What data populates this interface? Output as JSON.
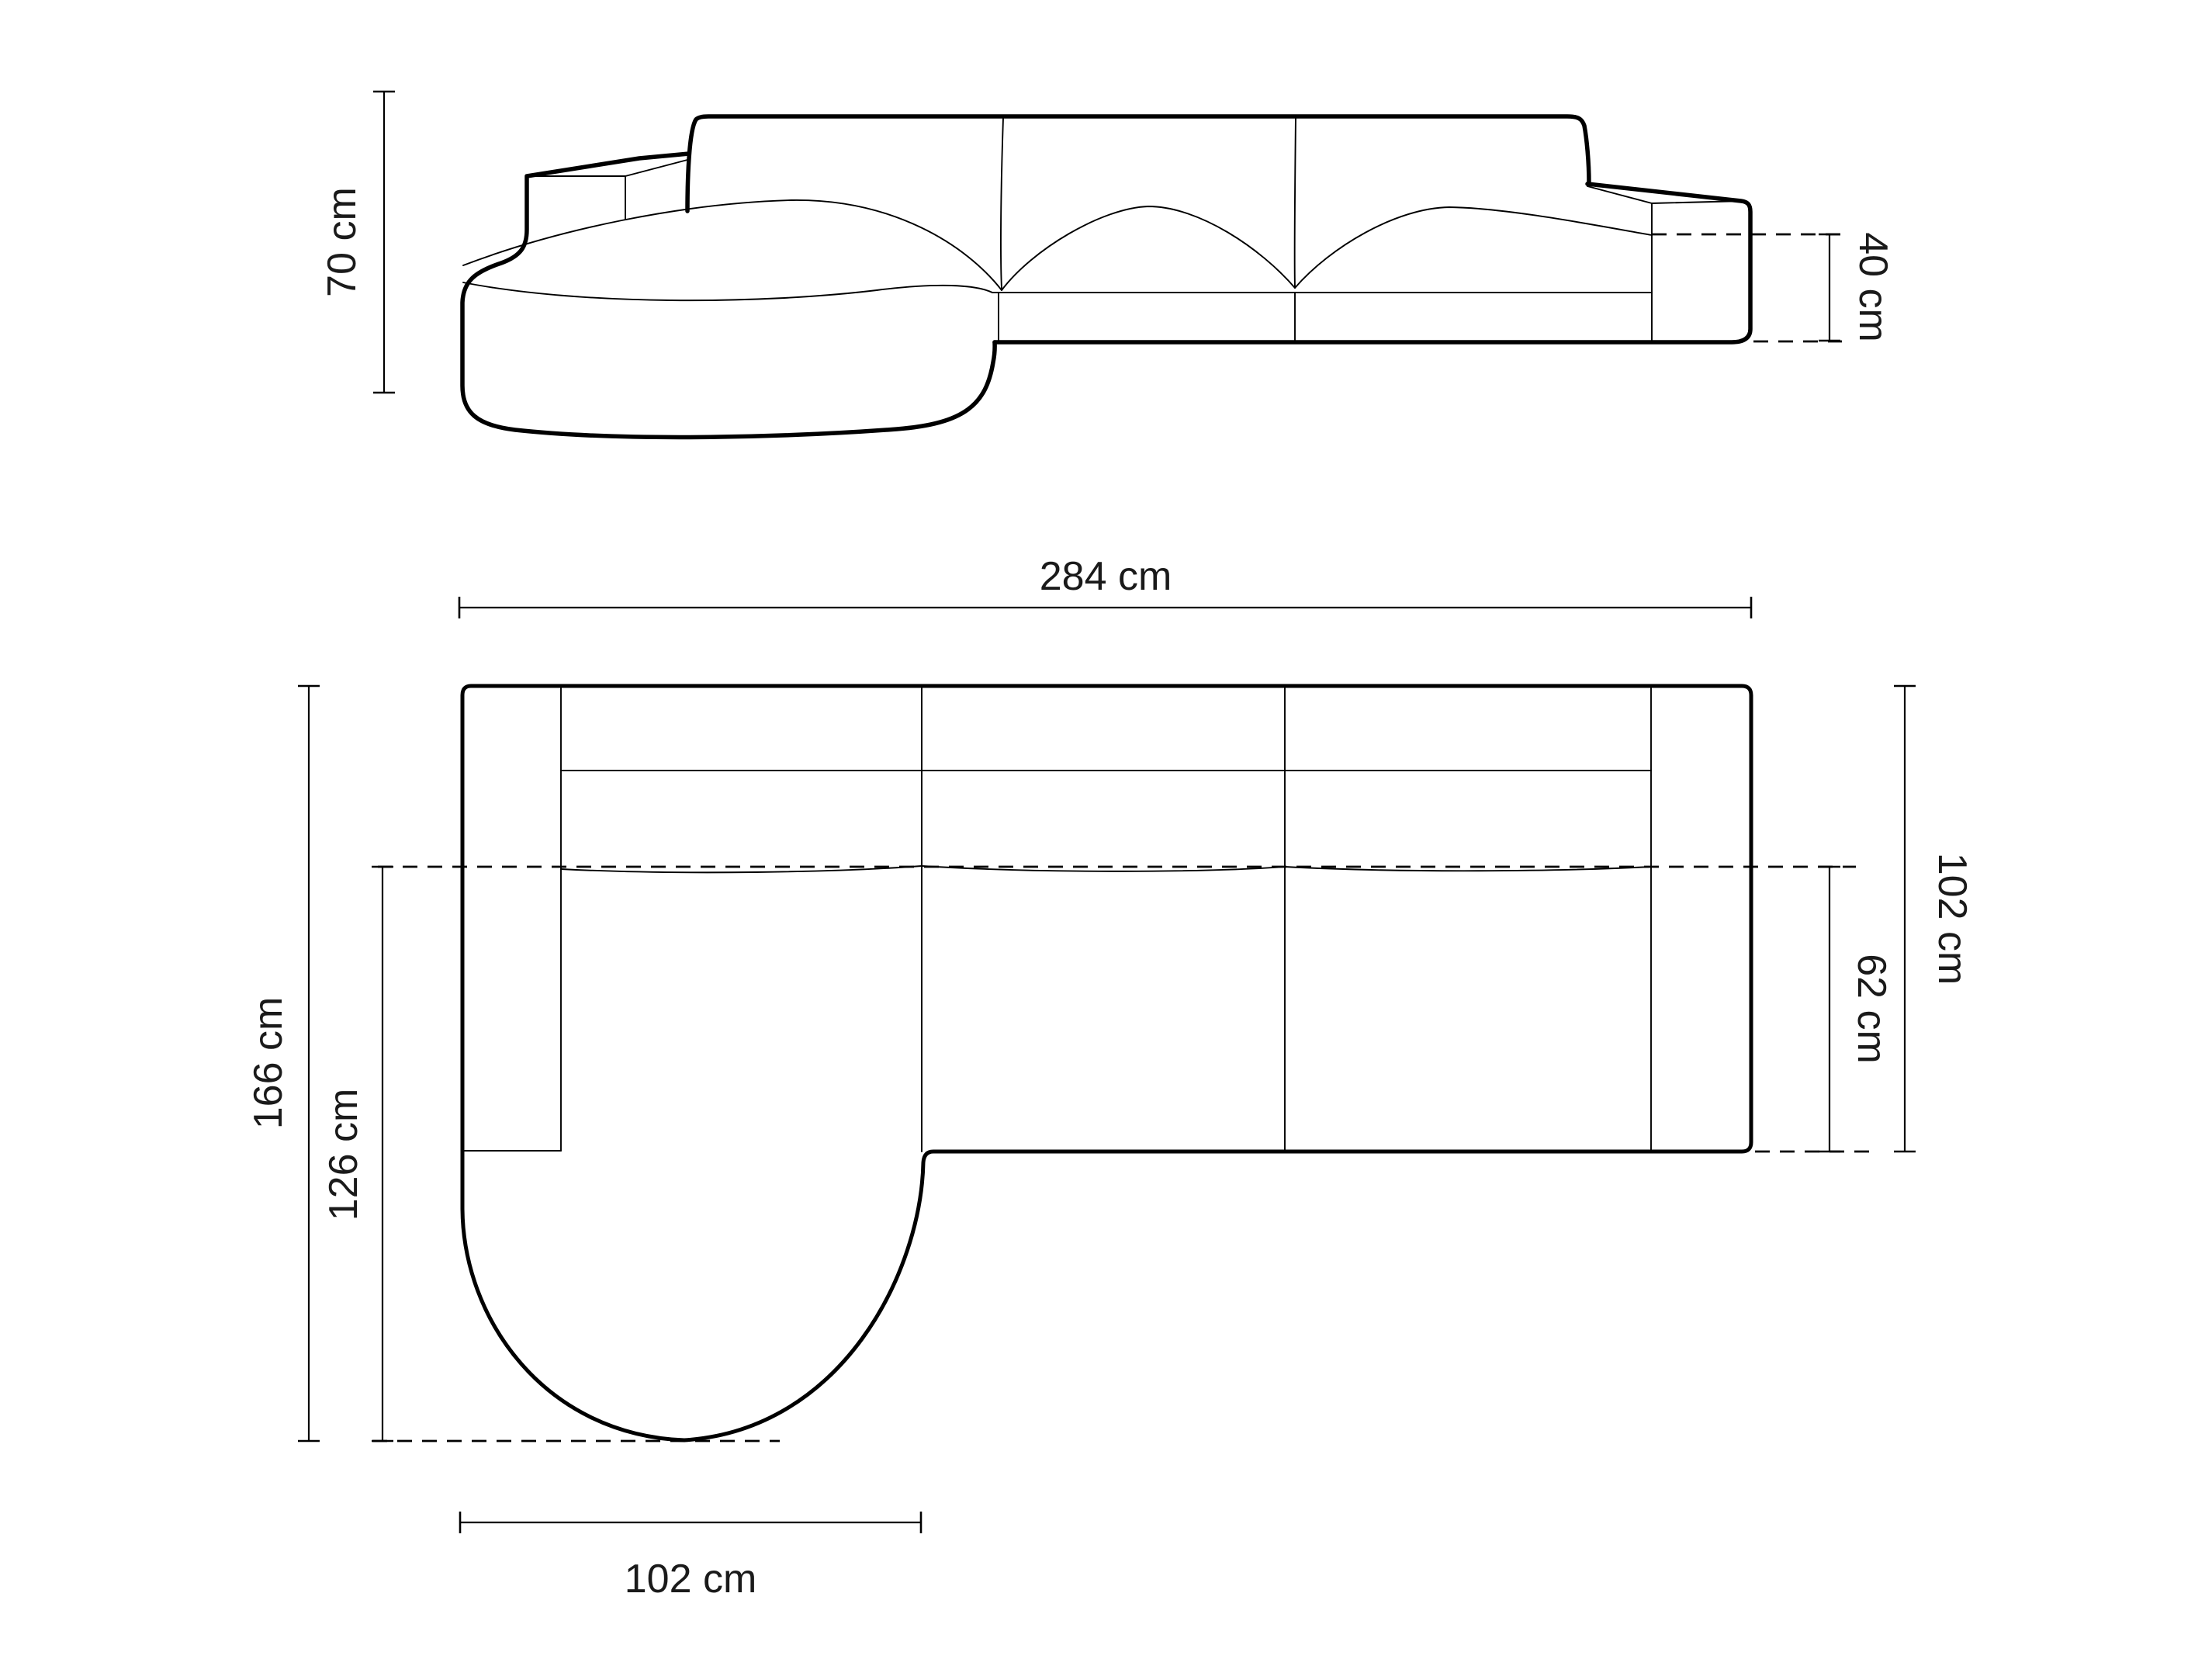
{
  "colors": {
    "background": "#ffffff",
    "line": "#000000",
    "text": "#1a1a1a"
  },
  "front_view": {
    "height_label": "70 cm",
    "seat_height_label": "40 cm"
  },
  "plan_view": {
    "overall_width_label": "284 cm",
    "overall_depth_label": "166 cm",
    "chaise_depth_label": "126 cm",
    "right_depth_label": "102 cm",
    "seat_depth_label": "62 cm",
    "chaise_width_label": "102 cm"
  }
}
